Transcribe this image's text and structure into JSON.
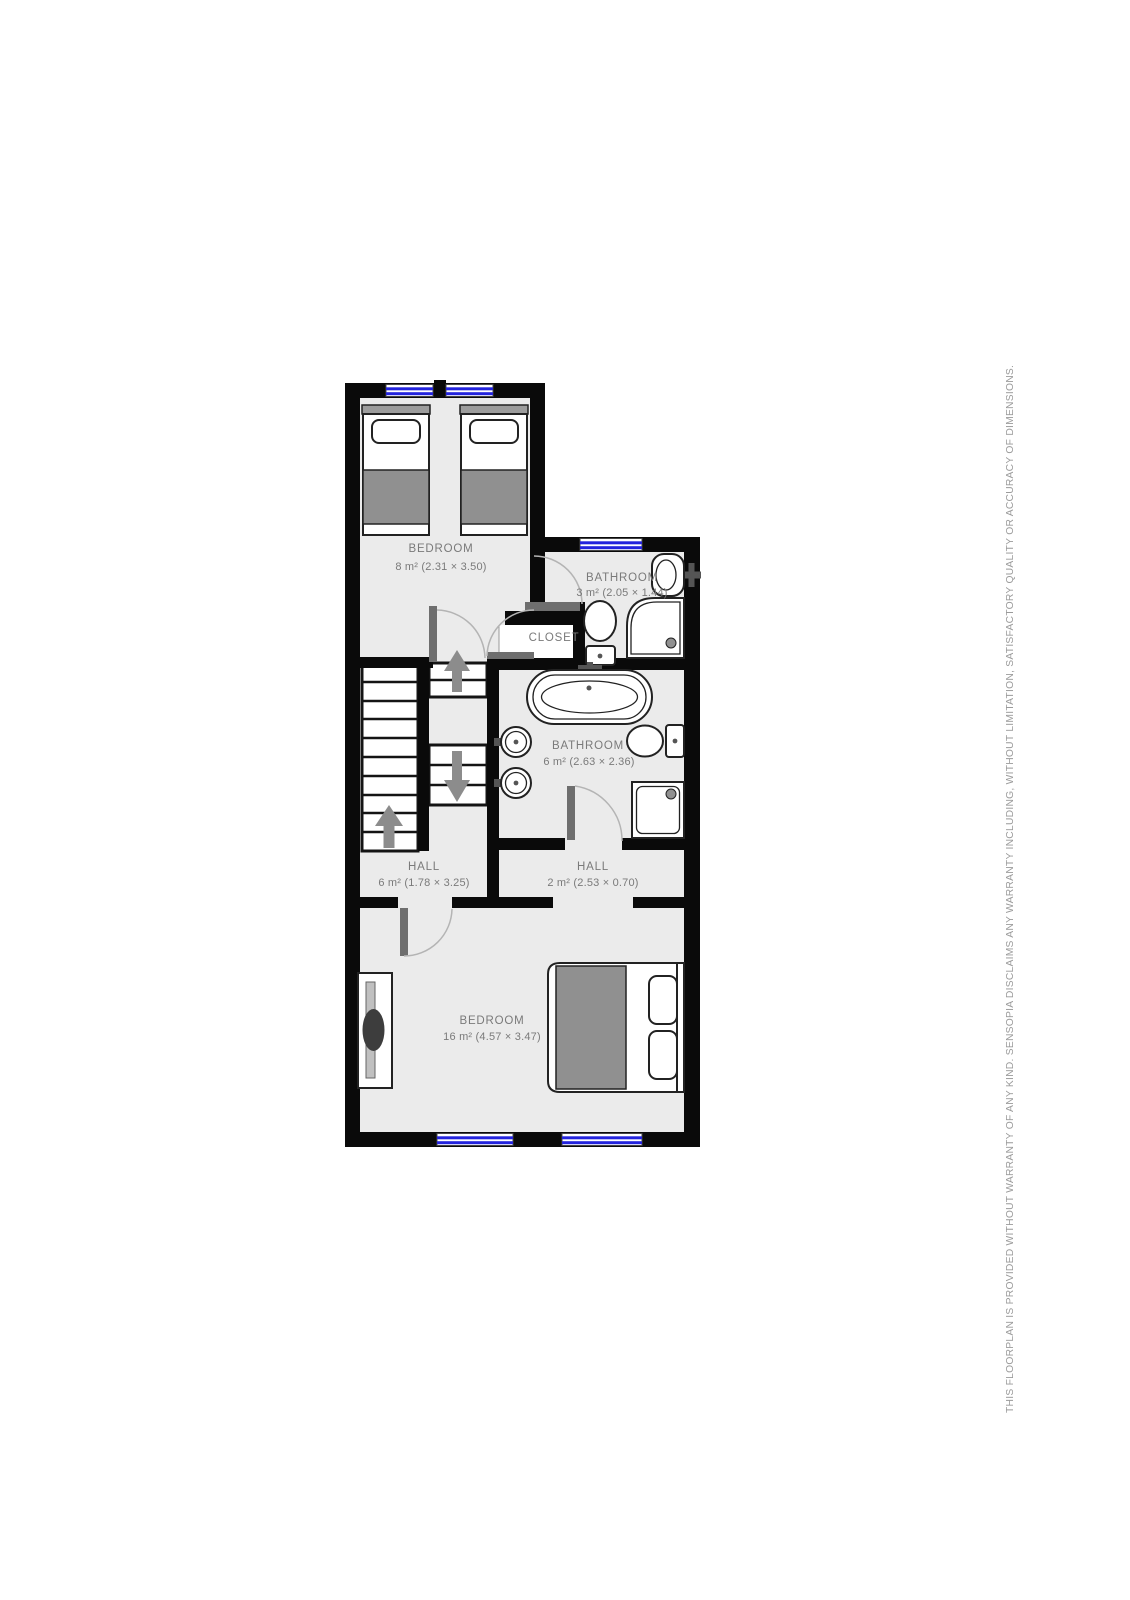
{
  "canvas": {
    "width": 1130,
    "height": 1600,
    "background": "#ffffff"
  },
  "disclaimer": {
    "text": "THIS FLOORPLAN IS PROVIDED WITHOUT WARRANTY OF ANY KIND. SENSOPIA DISCLAIMS ANY WARRANTY INCLUDING, WITHOUT LIMITATION, SATISFACTORY QUALITY OR ACCURACY OF DIMENSIONS."
  },
  "floorplan": {
    "rooms": {
      "bedroom_top": {
        "name": "BEDROOM",
        "dims": "8 m² (2.31 × 3.50)"
      },
      "bathroom_small": {
        "name": "BATHROOM",
        "dims": "3 m² (2.05 × 1.44)"
      },
      "closet": {
        "name": "CLOSET"
      },
      "bathroom_main": {
        "name": "BATHROOM",
        "dims": "6 m² (2.63 × 2.36)"
      },
      "hall_left": {
        "name": "HALL",
        "dims": "6 m² (1.78 × 3.25)"
      },
      "hall_right": {
        "name": "HALL",
        "dims": "2 m² (2.53 × 0.70)"
      },
      "bedroom_master": {
        "name": "BEDROOM",
        "dims": "16 m² (4.57 × 3.47)"
      }
    },
    "colors": {
      "wall": "#0a0a0a",
      "floor": "#ebebeb",
      "window_glass": "#2323dd",
      "furniture_gray": "#909090",
      "door_leaf": "#6e6e6e",
      "label_text": "#7a7a7a",
      "disclaimer_text": "#9b9b9b"
    }
  }
}
